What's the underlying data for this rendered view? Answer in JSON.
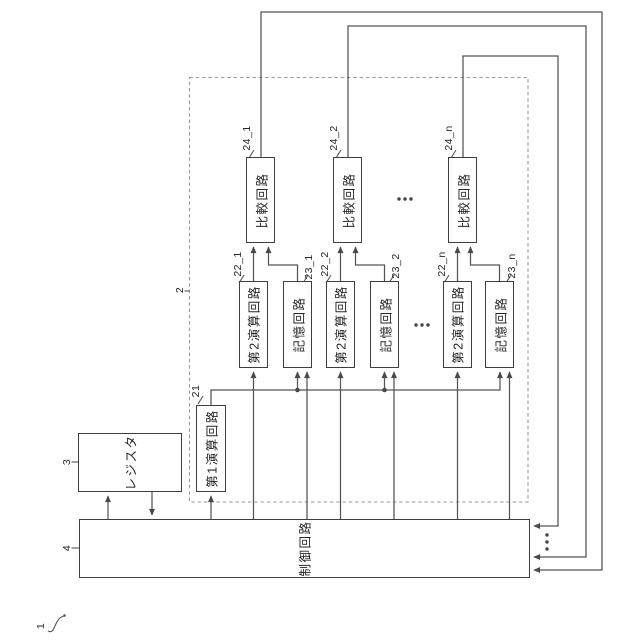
{
  "figure": {
    "fig_ref": "1",
    "dashed_group_ref": "2",
    "line_color": "#555555",
    "box_border_color": "#3e3e3e",
    "background": "#ffffff"
  },
  "blocks": {
    "register": {
      "label": "レジスタ",
      "ref": "3"
    },
    "control": {
      "label": "制御回路",
      "ref": "4"
    },
    "first_arithmetic": {
      "label": "第1演算回路",
      "ref": "21"
    },
    "groups": [
      {
        "second_arithmetic": {
          "label": "第2演算回路",
          "ref": "22_1"
        },
        "memory": {
          "label": "記憶回路",
          "ref": "23_1"
        },
        "comparison": {
          "label": "比較回路",
          "ref": "24_1"
        }
      },
      {
        "second_arithmetic": {
          "label": "第2演算回路",
          "ref": "22_2"
        },
        "memory": {
          "label": "記憶回路",
          "ref": "23_2"
        },
        "comparison": {
          "label": "比較回路",
          "ref": "24_2"
        }
      },
      {
        "second_arithmetic": {
          "label": "第2演算回路",
          "ref": "22_n"
        },
        "memory": {
          "label": "記憶回路",
          "ref": "23_n"
        },
        "comparison": {
          "label": "比較回路",
          "ref": "24_n"
        }
      }
    ]
  }
}
